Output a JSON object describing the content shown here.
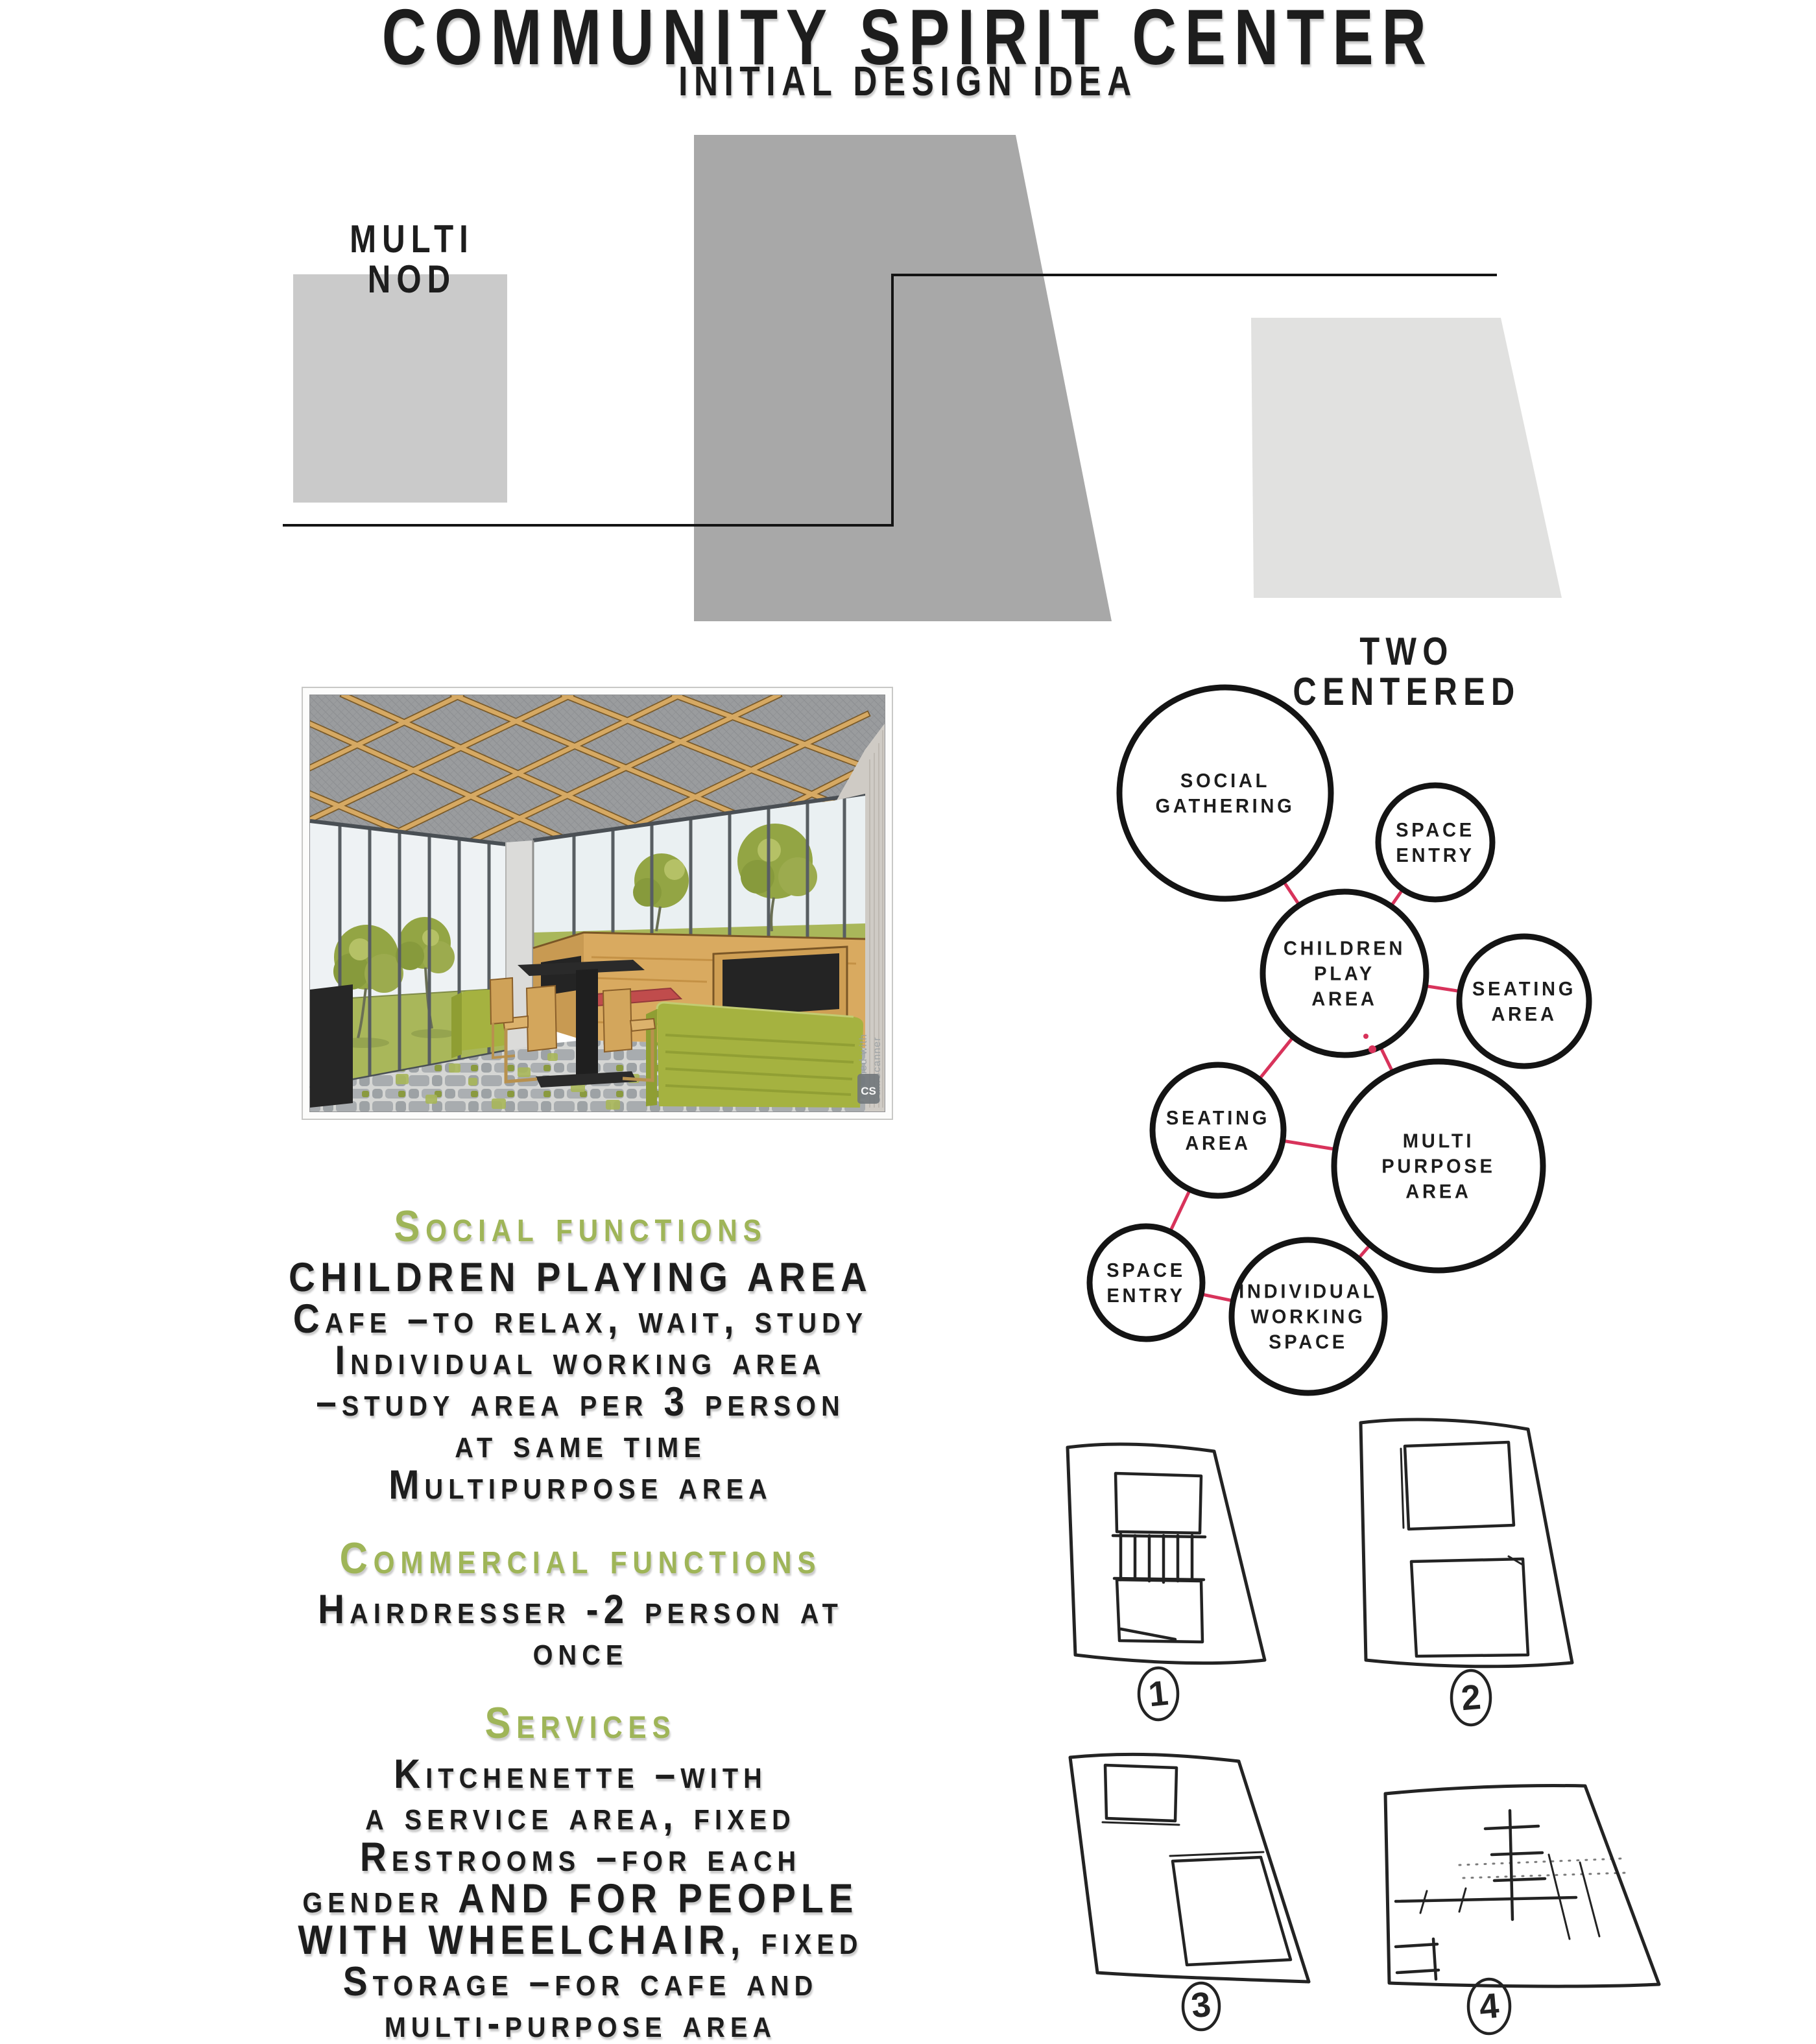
{
  "palette": {
    "heading_green": "#9fb558",
    "connector_red": "#d8335b",
    "diagram_ink": "#141414",
    "sketch_ink": "#232323",
    "massing_dark_gray": "#a8a8a8",
    "massing_light_gray": "#cacaca",
    "massing_lighter_gray": "#e1e1e0",
    "wood_tan": "#d9aa60",
    "sofa_green": "#a5b240",
    "cushion_red": "#c04c4c",
    "panel_black": "#242424",
    "leaf_green": "#93a544",
    "grass_green": "#a9b75a",
    "watermark_gray": "#9aa0a3"
  },
  "header": {
    "title": "COMMUNITY SPIRIT CENTER",
    "subtitle": "INITIAL DESIGN IDEA"
  },
  "massing": {
    "left_label": "MULTI NOD",
    "right_label": "TWO CENTERED"
  },
  "rendering": {
    "watermark_line1": "Scanned with",
    "watermark_line2": "CamScanner",
    "badge": "CS"
  },
  "bubbles": {
    "social": {
      "lines": [
        "SOCIAL",
        "GATHERING"
      ]
    },
    "space_entry_top": {
      "lines": [
        "SPACE",
        "ENTRY"
      ]
    },
    "children": {
      "lines": [
        "CHILDREN",
        "PLAY",
        "AREA"
      ]
    },
    "seating_right": {
      "lines": [
        "SEATING",
        "AREA"
      ]
    },
    "seating_left": {
      "lines": [
        "SEATING",
        "AREA"
      ]
    },
    "multi_purpose": {
      "lines": [
        "MULTI",
        "PURPOSE",
        "AREA"
      ]
    },
    "space_entry_bottom": {
      "lines": [
        "SPACE",
        "ENTRY"
      ]
    },
    "individual": {
      "lines": [
        "INDIVIDUAL",
        "WORKING",
        "SPACE"
      ]
    }
  },
  "sections": [
    {
      "heading": "Social functions",
      "lines": [
        "CHILDREN PLAYING AREA",
        "Cafe –to relax, wait, study",
        "Individual working area",
        "–study area per 3 person",
        "at same time",
        "Multipurpose area"
      ]
    },
    {
      "heading": "Commercial functions",
      "lines": [
        "Hairdresser -2 person at",
        "once"
      ]
    },
    {
      "heading": "Services",
      "lines": [
        "Kitchenette –with",
        "a service area, fixed",
        "Restrooms –for each",
        "gender AND FOR PEOPLE",
        "WITH WHEELCHAIR, fixed",
        "Storage –for cafe and",
        "multi-purpose area"
      ]
    }
  ],
  "sketches": {
    "labels": [
      "1",
      "2",
      "3",
      "4"
    ]
  }
}
